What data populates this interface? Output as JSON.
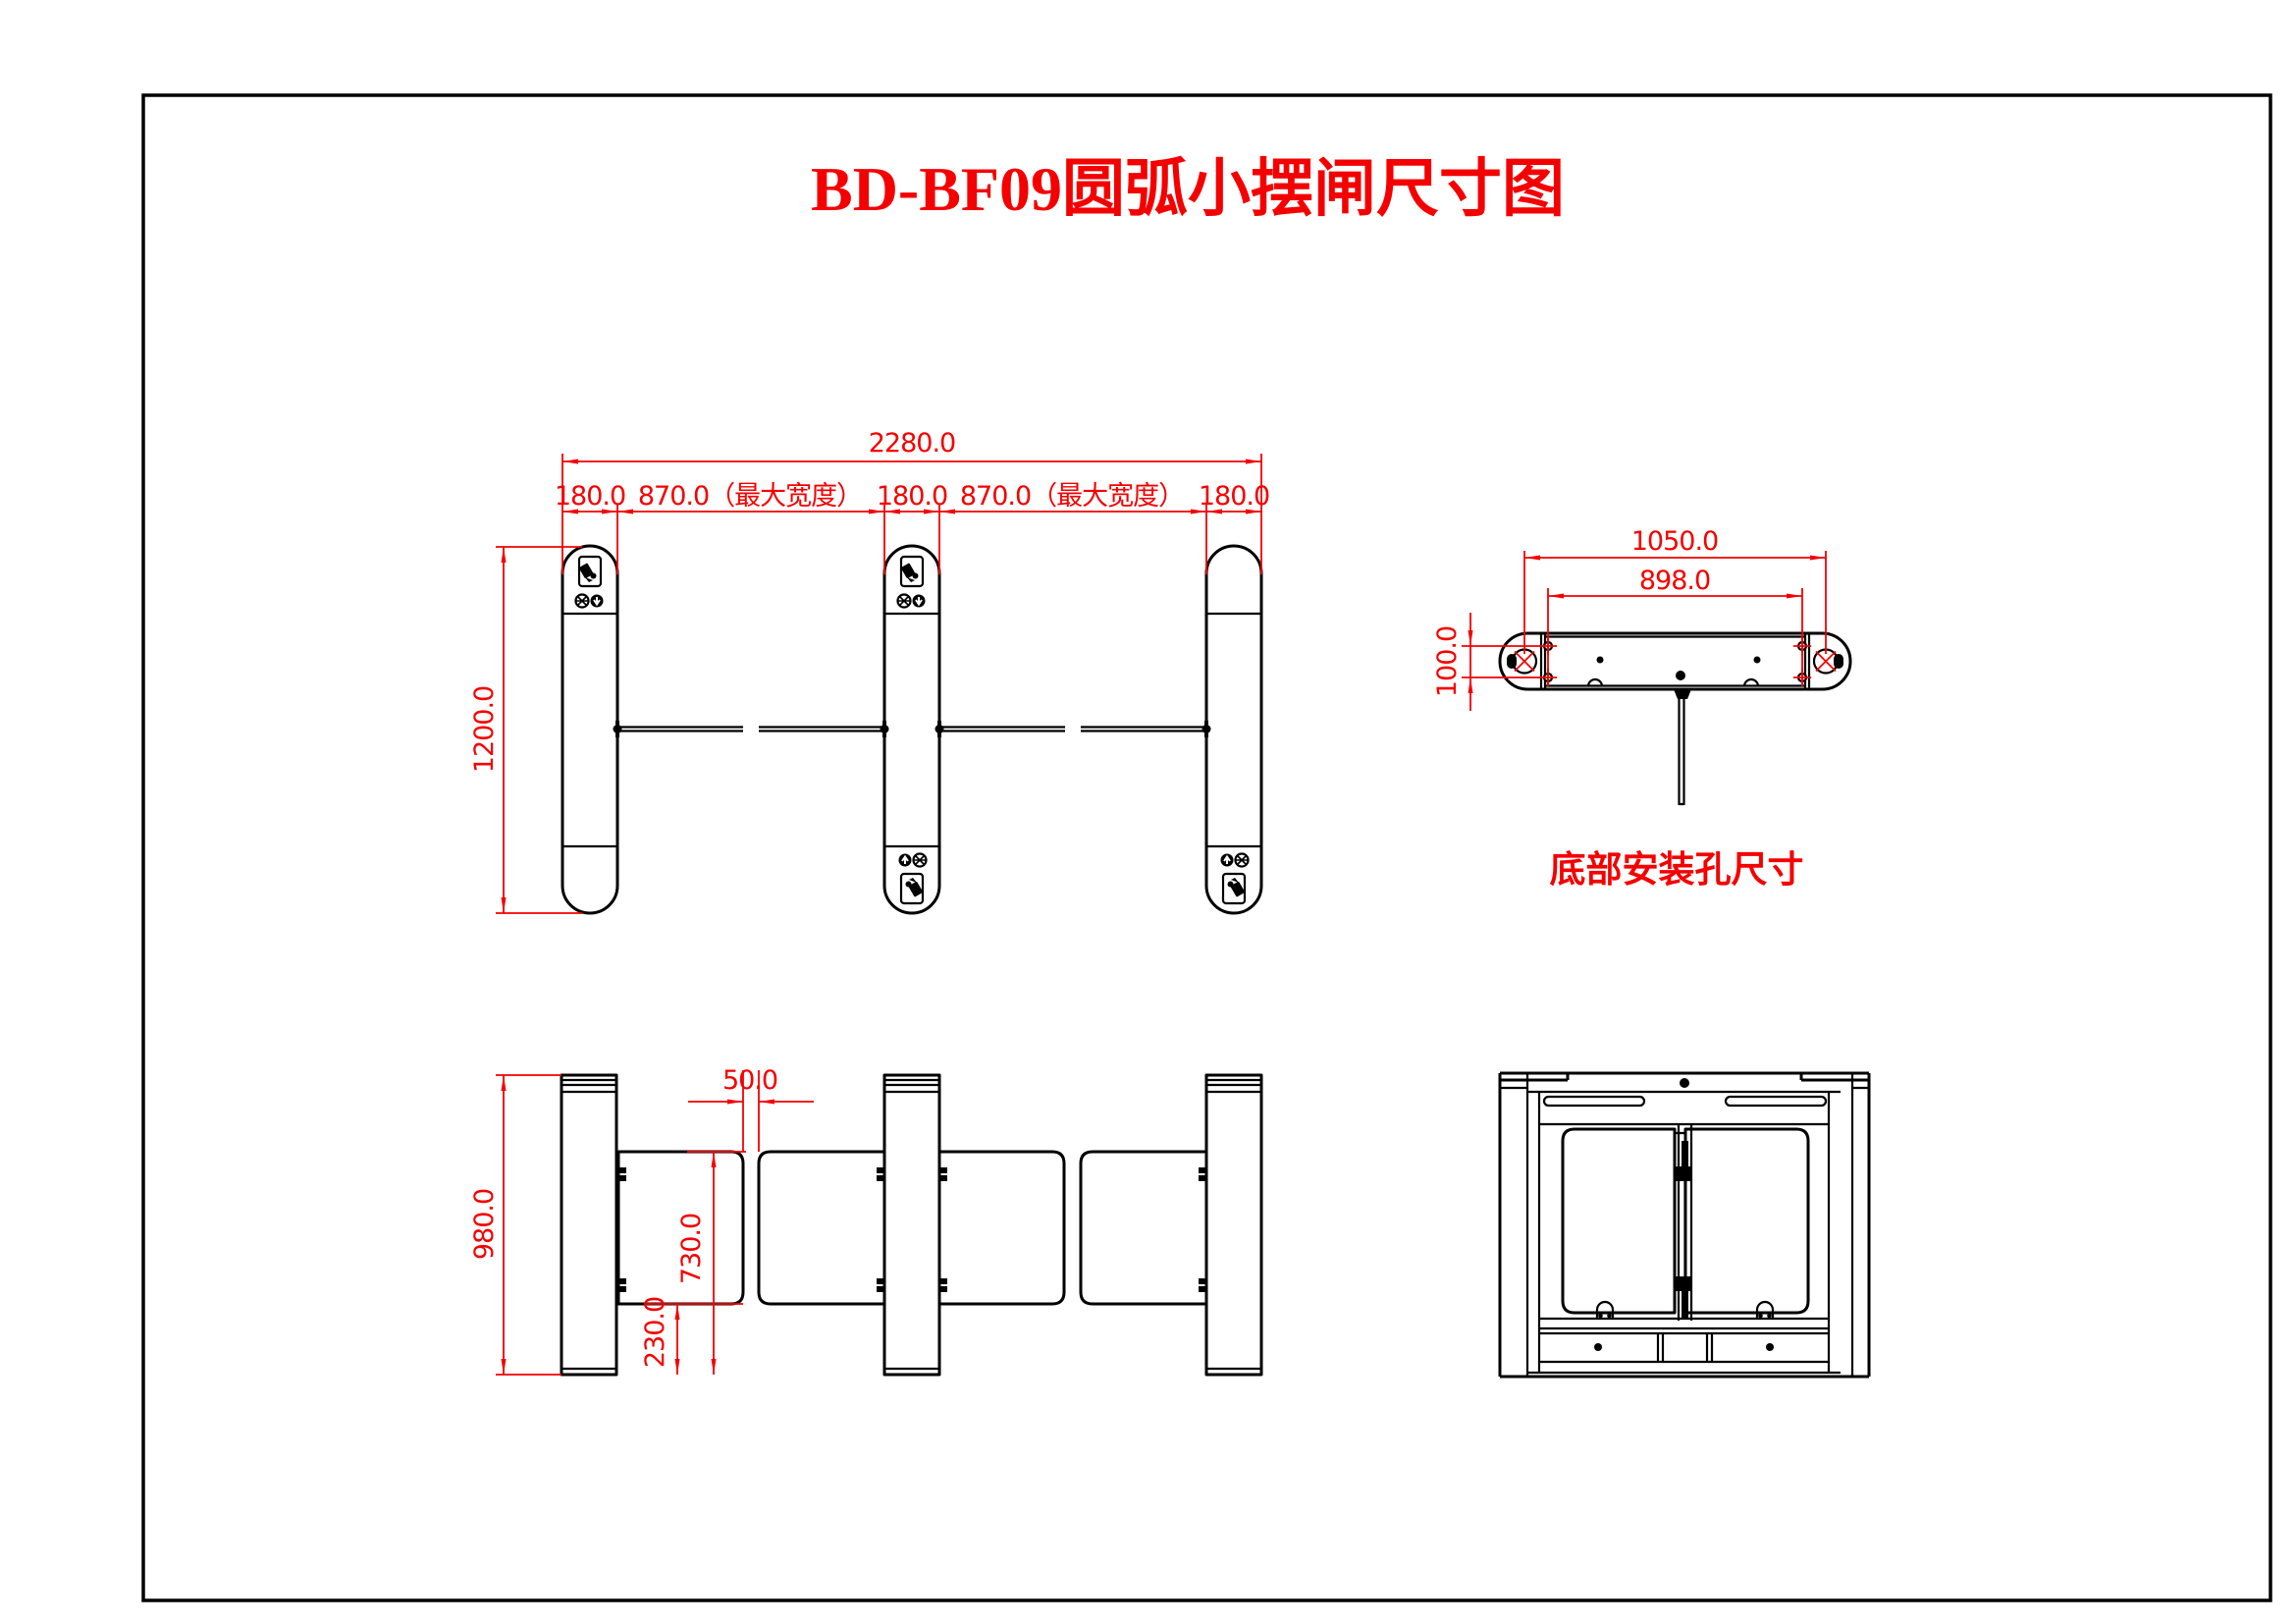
{
  "colors": {
    "dimension_red": "#f40000",
    "line_black": "#000000",
    "background": "#ffffff"
  },
  "title": "BD-BF09圆弧小摆闸尺寸图",
  "plan_view": {
    "dim_total_width": "2280.0",
    "dim_cabinet_left": "180.0",
    "dim_passage_left": "870.0（最大宽度）",
    "dim_cabinet_middle": "180.0",
    "dim_passage_right": "870.0（最大宽度）",
    "dim_cabinet_right": "180.0",
    "dim_cabinet_depth": "1200.0"
  },
  "front_view": {
    "dim_cabinet_height": "980.0",
    "dim_wing_gap": "50.0",
    "dim_wing_top_height": "730.0",
    "dim_wing_bottom_height": "230.0"
  },
  "mounting_view": {
    "caption": "底部安装孔尺寸",
    "dim_outer_hole_span": "1050.0",
    "dim_inner_hole_span": "898.0",
    "dim_hole_row_spacing": "100.0"
  }
}
